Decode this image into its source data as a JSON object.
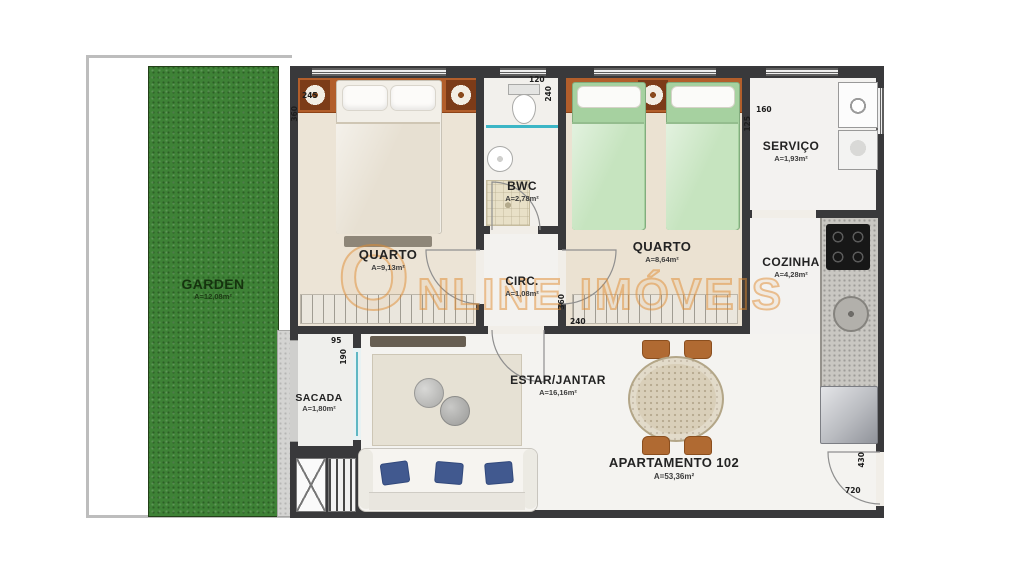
{
  "plan": {
    "unit_label": "APARTAMENTO 102",
    "unit_area": "A=53,36m²",
    "watermark": {
      "brand": "ONLINE IMÓVEIS"
    },
    "rooms": [
      {
        "id": "garden",
        "label": "GARDEN",
        "area": "A=12,08m²"
      },
      {
        "id": "quarto-1",
        "label": "QUARTO",
        "area": "A=9,13m²"
      },
      {
        "id": "bwc",
        "label": "BWC",
        "area": "A=2,78m²"
      },
      {
        "id": "circ",
        "label": "CIRC.",
        "area": "A=1,08m²"
      },
      {
        "id": "quarto-2",
        "label": "QUARTO",
        "area": "A=8,64m²"
      },
      {
        "id": "servico",
        "label": "SERVIÇO",
        "area": "A=1,93m²"
      },
      {
        "id": "cozinha",
        "label": "COZINHA",
        "area": "A=4,28m²"
      },
      {
        "id": "estar-jantar",
        "label": "ESTAR/JANTAR",
        "area": "A=16,16m²"
      },
      {
        "id": "sacada",
        "label": "SACADA",
        "area": "A=1,80m²"
      }
    ],
    "dimensions_cm": [
      "245",
      "360",
      "120",
      "240",
      "160",
      "125",
      "360",
      "240",
      "95",
      "190",
      "430",
      "720"
    ],
    "colors": {
      "wall": "#39393b",
      "garden_green": "#3e8236",
      "floor_beige": "#ece4d6",
      "floor_white": "#f3f2ef",
      "headboard_orange": "#b25e2b",
      "bedding_green": "#a6d1a0",
      "pillow_blue": "#41598f",
      "watermark_orange": "#e08a2e",
      "glass_cyan": "#3cb6c6"
    }
  }
}
